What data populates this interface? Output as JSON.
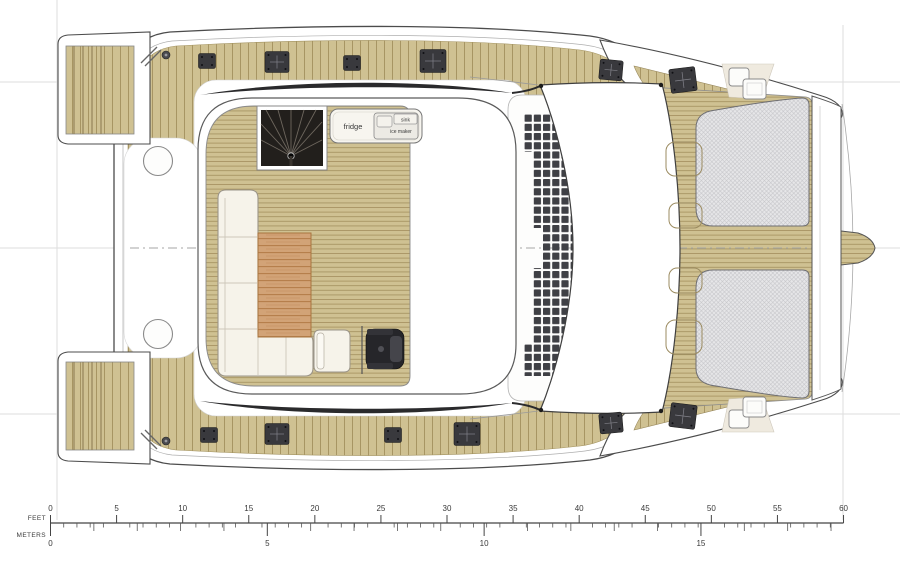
{
  "plan": {
    "name": "catamaran-deck-plan",
    "labels": {
      "fridge": "fridge",
      "sink": "sink",
      "ice_maker": "ice maker"
    }
  },
  "scale": {
    "feet_label": "FEET",
    "meters_label": "METERS",
    "feet": {
      "min": 0,
      "max": 60,
      "minor_step": 1,
      "major_step": 5,
      "major_labels": [
        "0",
        "5",
        "10",
        "15",
        "20",
        "25",
        "30",
        "35",
        "40",
        "45",
        "50",
        "55",
        "60"
      ]
    },
    "meters": {
      "min": 0,
      "max": 18,
      "minor_step": 1,
      "major_step": 5,
      "major_labels": [
        "0",
        "5",
        "10",
        "15"
      ]
    }
  },
  "colors": {
    "wood_base": "#cfc192",
    "wood_seam": "#a3905e",
    "wood_dark": "#8a784e",
    "table_base": "#d2a377",
    "table_grain": "#b27a45",
    "sofa_fill": "#f6f3ea",
    "sofa_stroke": "#9b9589",
    "seat_dark": "#26262a",
    "fixture_dark": "#39393d",
    "swoosh": "#2a2a2c",
    "stair_dark": "#221f1c",
    "tramp_base": "#e6e6e8",
    "tramp_mesh": "#c2c2c6",
    "panel_dark": "#3f4045",
    "cream": "#efeadf",
    "outline": "#4c4c4c",
    "outline_soft": "#9a9a9a",
    "guide": "#dedede",
    "text_dark": "#3a3a3a"
  }
}
